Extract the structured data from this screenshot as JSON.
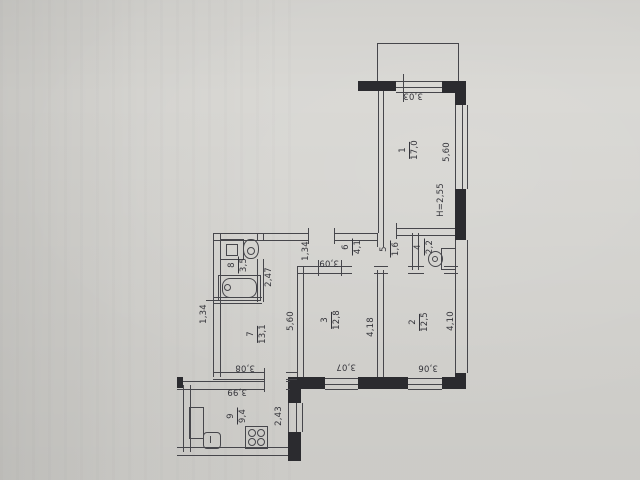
{
  "plan": {
    "title_note": "apartment floor plan photo",
    "line_color": "#46464b",
    "wall_fill": "#2b2b2f",
    "paper_color": "#d7d6d2",
    "ceiling_height": "H=2,55",
    "rooms": [
      {
        "number": "1",
        "area": "17,0"
      },
      {
        "number": "2",
        "area": "12,5"
      },
      {
        "number": "3",
        "area": "12,8"
      },
      {
        "number": "4",
        "area": "2,2"
      },
      {
        "number": "5",
        "area": "1,6"
      },
      {
        "number": "6",
        "area": "4,1"
      },
      {
        "number": "7",
        "area": "13,1"
      },
      {
        "number": "8",
        "area": "3,5"
      },
      {
        "number": "9",
        "area": "9,4"
      }
    ],
    "dimensions": {
      "room1_width": "3,03",
      "room1_height": "5,60",
      "hall_depth": "1,34",
      "hall_width": "3,09",
      "bath_depth": "2,47",
      "left_wall_seg": "1,34",
      "room7_height": "5,60",
      "room7_width": "3,08",
      "room3_height": "4,18",
      "room3_width": "3,07",
      "room2_height": "4,10",
      "room2_width": "3,06",
      "kitchen_width": "3,99",
      "kitchen_depth": "2,43"
    }
  }
}
